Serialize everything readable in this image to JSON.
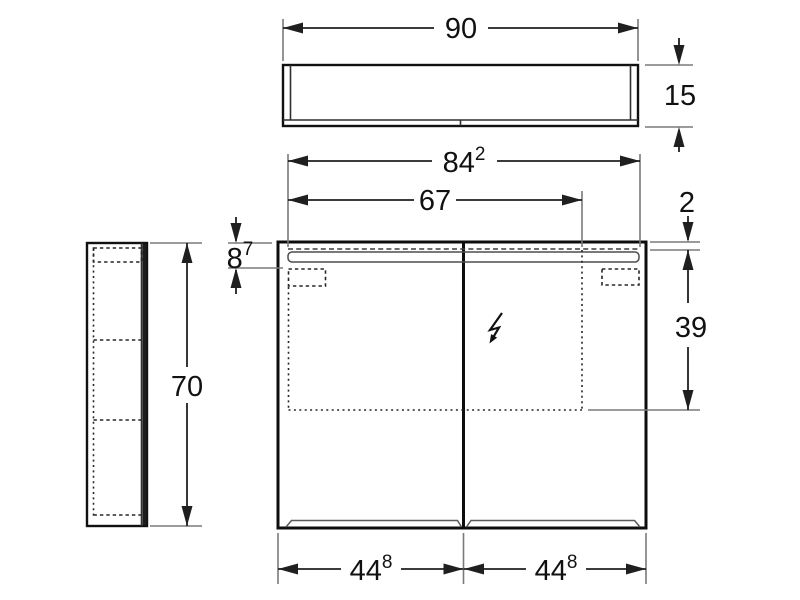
{
  "colors": {
    "background": "#ffffff",
    "object_line": "#111111",
    "hidden_line": "#262626",
    "extension_line": "#7a7a7a",
    "dimension_line": "#1f1f1f",
    "text": "#111111"
  },
  "icons": {
    "power_connection": "lightning-bolt"
  },
  "dimensions": {
    "top_width": {
      "main": "90",
      "sup": ""
    },
    "top_depth": {
      "main": "15",
      "sup": ""
    },
    "mirror_width": {
      "main": "84",
      "sup": "2"
    },
    "light_width": {
      "main": "67",
      "sup": ""
    },
    "top_gap": {
      "main": "2",
      "sup": ""
    },
    "hinge_offset": {
      "main": "8",
      "sup": "7"
    },
    "inner_height": {
      "main": "39",
      "sup": ""
    },
    "height": {
      "main": "70",
      "sup": ""
    },
    "door_left_width": {
      "main": "44",
      "sup": "8"
    },
    "door_right_width": {
      "main": "44",
      "sup": "8"
    }
  }
}
